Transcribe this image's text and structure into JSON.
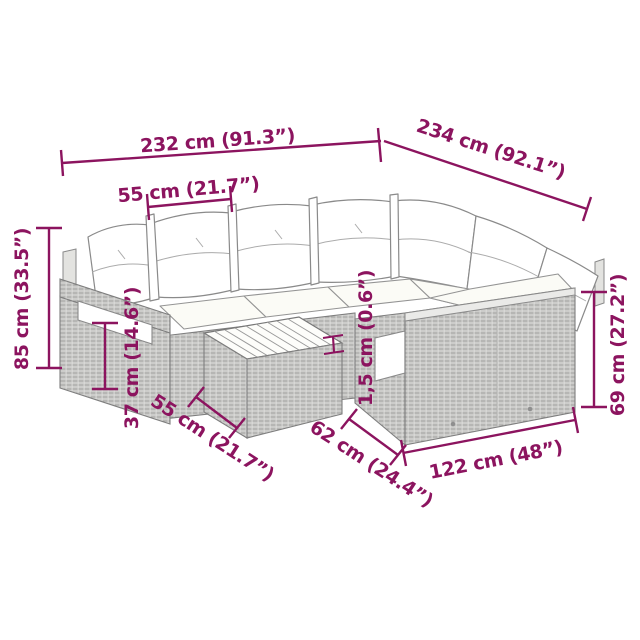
{
  "diagram": {
    "type": "product-dimension-diagram",
    "subject": "rattan corner lounge set with cushions and coffee table",
    "accent_color": "#8C145F",
    "background_color": "#FFFFFF",
    "labels": {
      "overall_width": "232 cm (91.3”)",
      "overall_depth": "234 cm (92.1”)",
      "back_cushion_width": "55 cm (21.7”)",
      "overall_height": "85 cm (33.5”)",
      "seat_height": "37 cm (14.6”)",
      "table_width": "55 cm (21.7”)",
      "cushion_thickness": "1,5 cm (0.6”)",
      "module_depth": "62 cm (24.4”)",
      "right_module_width": "122 cm (48”)",
      "side_height": "69 cm (27.2”)"
    }
  }
}
